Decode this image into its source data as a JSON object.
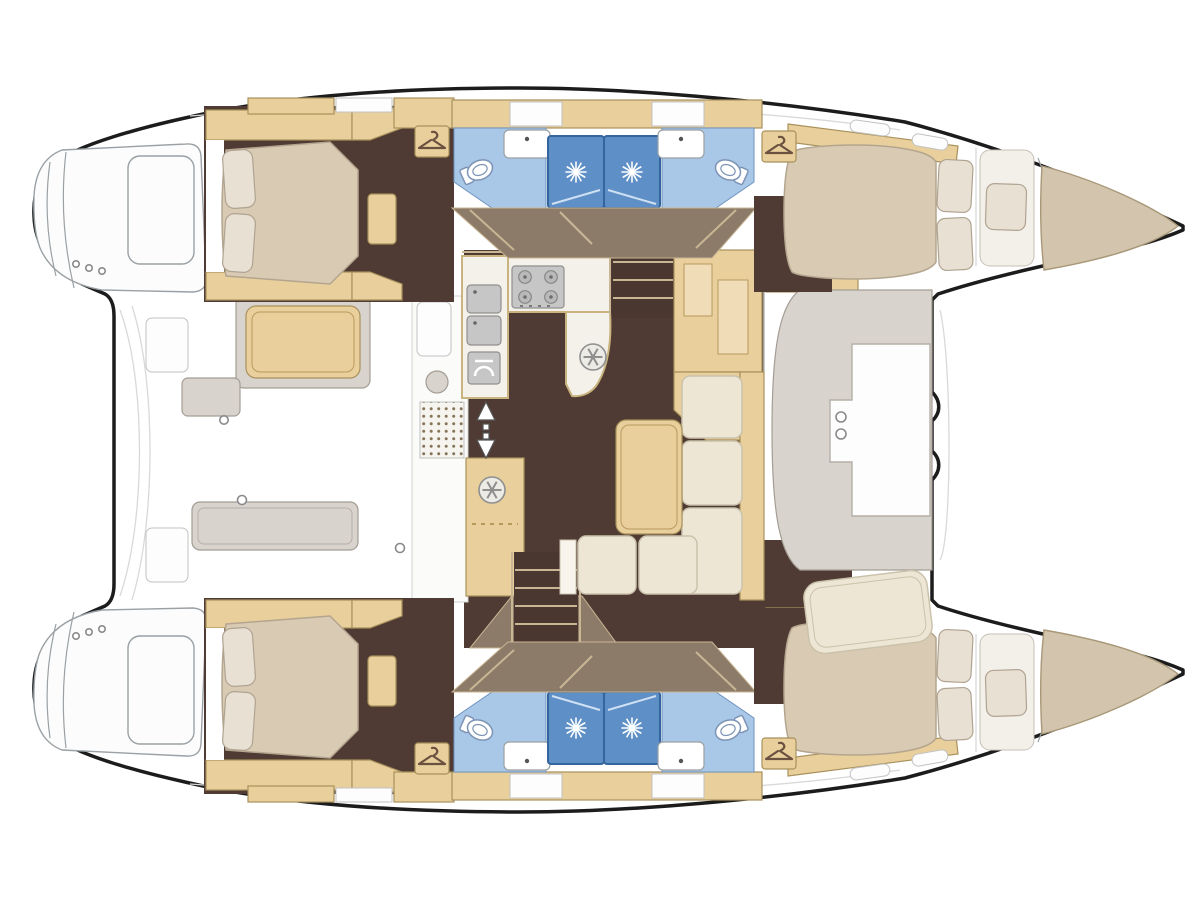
{
  "meta": {
    "description": "Top-down floor plan diagram of a sailing catamaran with two hulls, four double cabins, four bathrooms with showers, central salon with U-shaped galley, nav station, settee and aft cockpit",
    "orientation": "bows pointing right, sterns with swim platforms at left"
  },
  "colors": {
    "background": "#ffffff",
    "outline": "#1c1c1c",
    "floor_dark": "#4f3b33",
    "corridor_brown": "#8d7b69",
    "wood_light": "#e9cf9c",
    "bath_floor_blue": "#a9c7e7",
    "shower_blue": "#5e8fc6",
    "mattress_beige": "#d9cbb3",
    "pillow_cream": "#e8e0d2",
    "sofa_cream": "#ede6d4",
    "furniture_gray": "#d8d3cd",
    "counter_white": "#f4f1ea",
    "appliance_gray": "#c6c6c6"
  },
  "icons": {
    "hanger": "wardrobe-hanger-icon",
    "shower_sun": "shower-drain-sun-icon",
    "hatch_wheel": "deck-hatch-wheel-icon",
    "toilet": "toilet-icon",
    "burner": "stove-burner-icon",
    "oven": "oven-icon",
    "arrow": "companionway-arrow-icon",
    "ring": "mooring-ring-icon"
  },
  "rooms": {
    "boat": "Catamaran hull outline",
    "port_hull": "Port hull (top)",
    "starboard_hull": "Starboard hull (bottom)",
    "aft_cabin": "Aft double berth cabin with pillows",
    "fwd_cabin": "Forward double berth cabin with pillows",
    "forepeak": "Forepeak single berth",
    "bow_locker": "Bow storage locker",
    "head": "Bathroom with toilet and washbasin",
    "shower": "Shower stall",
    "wardrobe": "Wardrobe locker",
    "corridor": "Hull companionway corridor",
    "transom": "Transom steps / swim platform",
    "salon": "Salon on bridge deck",
    "galley": "U-shaped galley",
    "stove": "Four-burner stove",
    "sinks": "Double galley sink",
    "oven": "Oven",
    "fridge": "Refrigerator cabinet with deck hatch",
    "nav_station": "Navigation station cabinets",
    "sofa": "L-shaped salon settee",
    "table": "Salon table",
    "helm_console": "Forward console seat",
    "front_seat": "Forward facing settee",
    "companionway_port": "Steps down to port hull",
    "companionway_stbd": "Steps down to starboard hull",
    "entry_arrow": "Sliding-door entry arrow",
    "entry_mat": "Entry mat",
    "wet_bar": "Cockpit wet bar module",
    "cockpit": "Aft cockpit",
    "cockpit_table": "Cockpit table",
    "cockpit_bench": "Cockpit bench",
    "cockpit_pad": "Cockpit seat cushion"
  }
}
